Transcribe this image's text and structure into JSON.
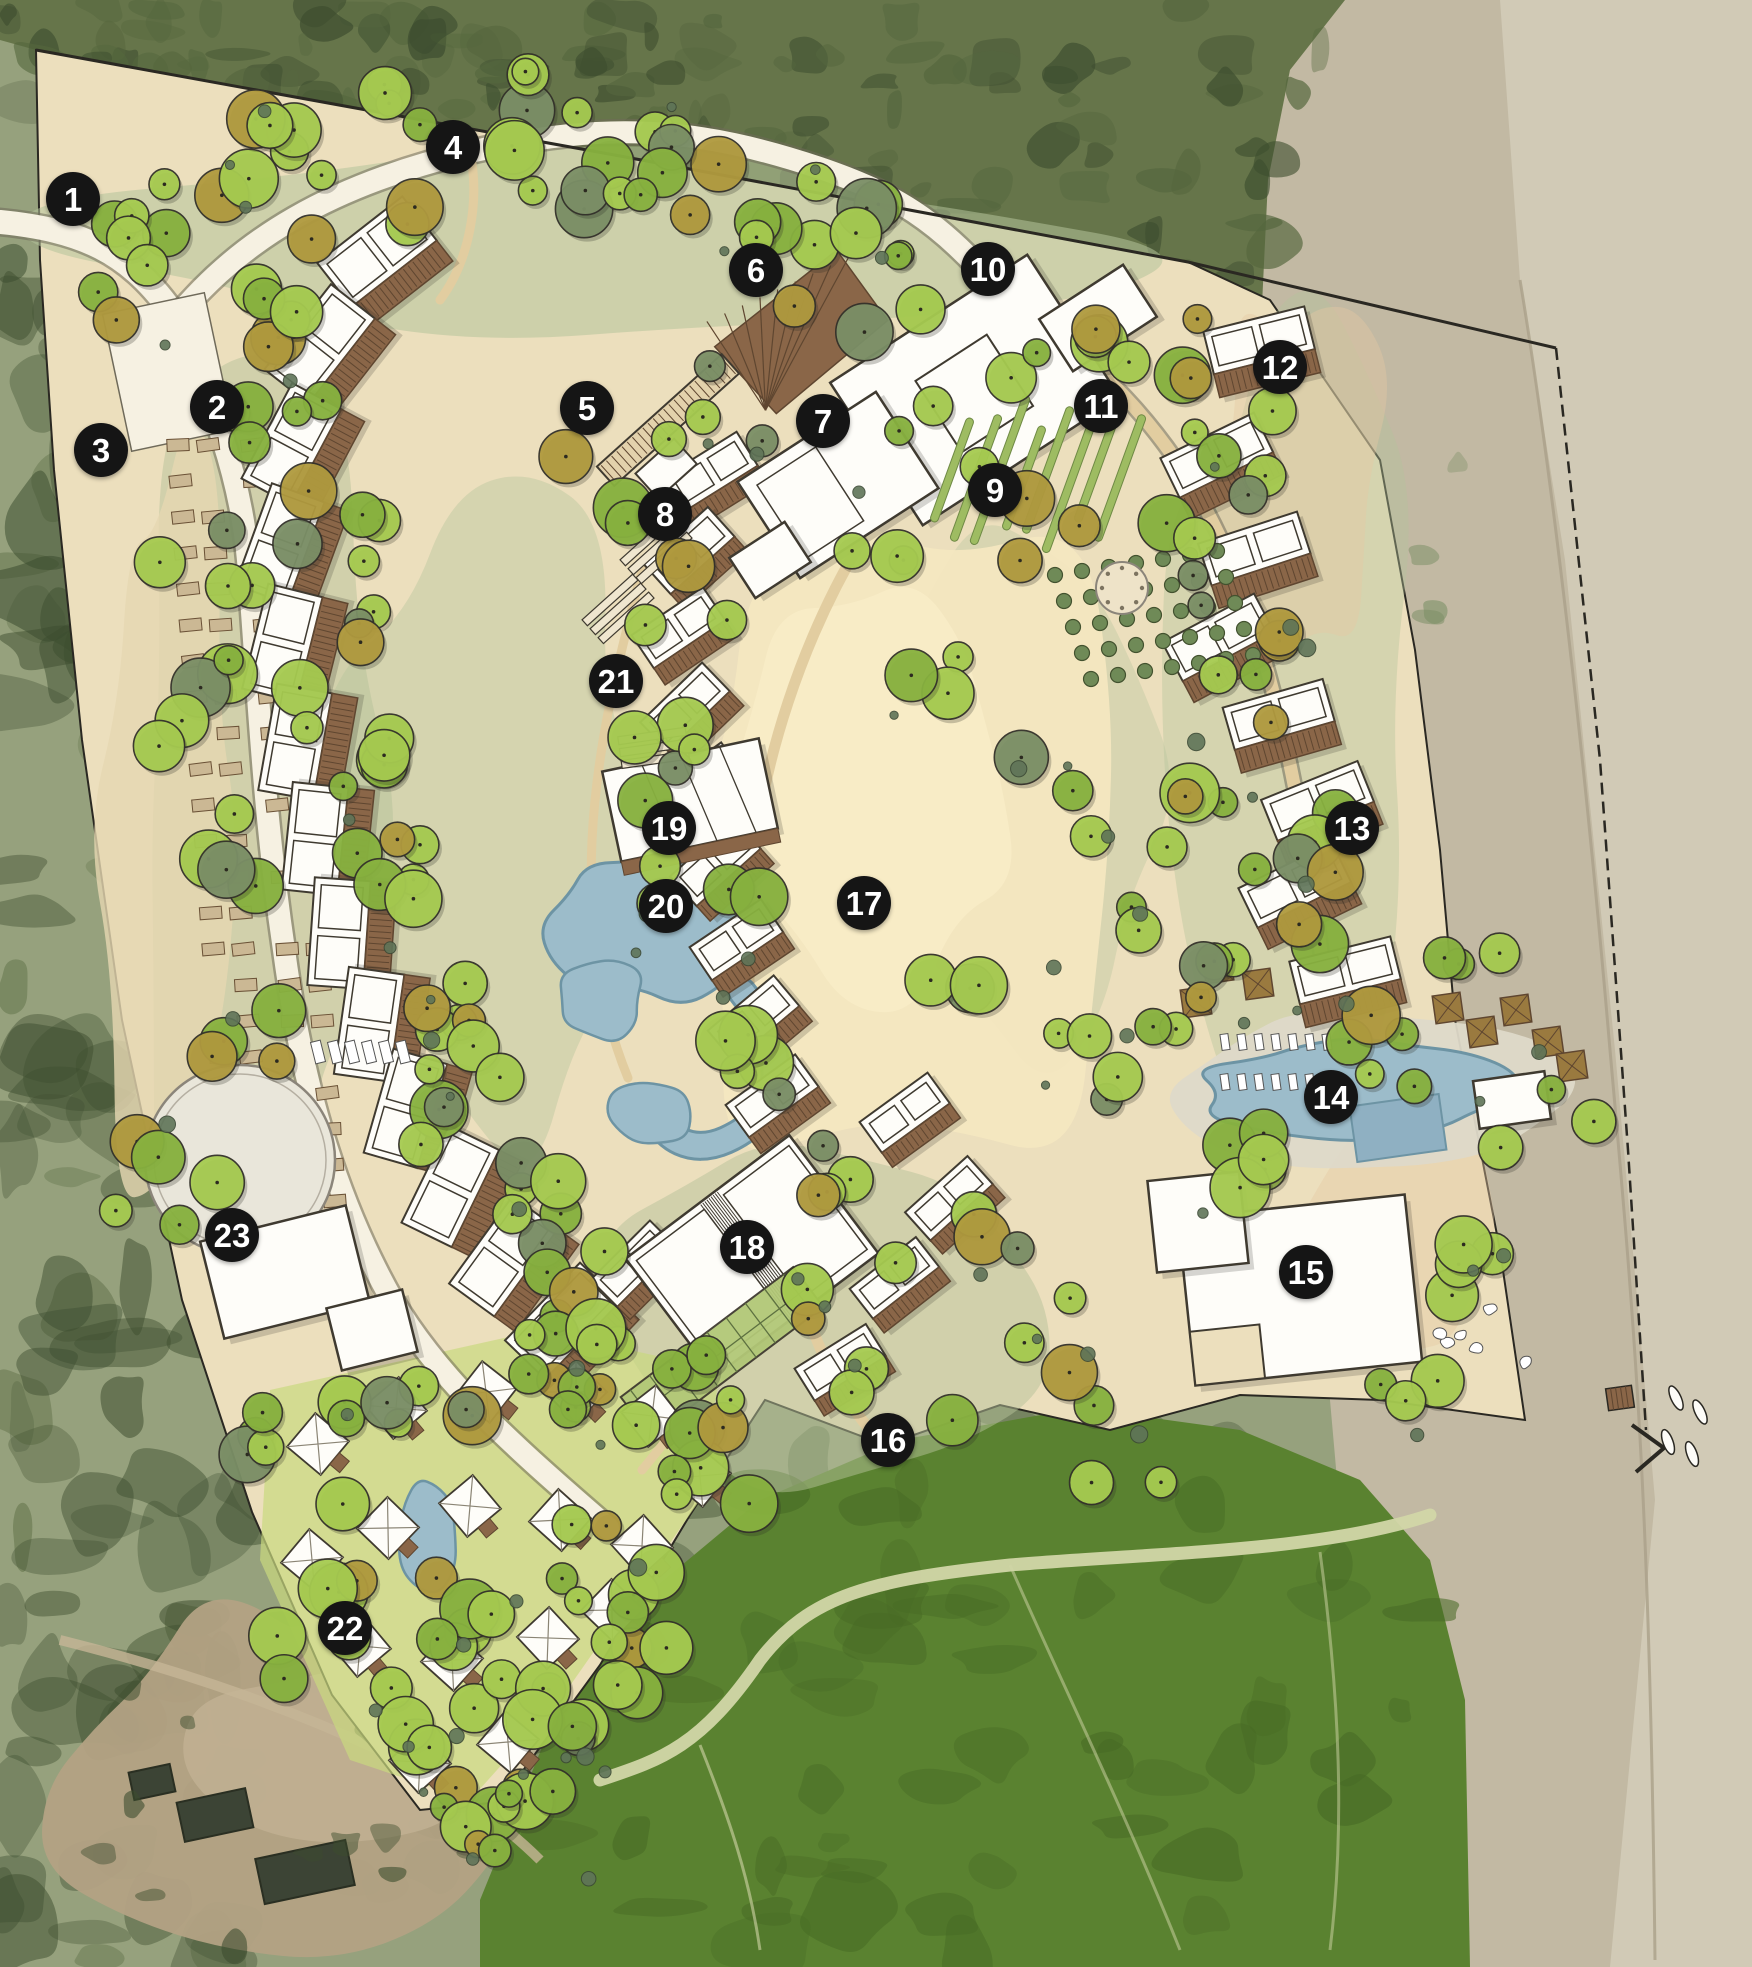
{
  "canvas": {
    "width": 1752,
    "height": 1967
  },
  "markers": {
    "style": {
      "diameter_px": 54,
      "background": "#151515",
      "text_color": "#ffffff",
      "font_size_px": 33
    },
    "items": [
      {
        "label": "1",
        "x": 73,
        "y": 199
      },
      {
        "label": "2",
        "x": 217,
        "y": 407
      },
      {
        "label": "3",
        "x": 101,
        "y": 450
      },
      {
        "label": "4",
        "x": 453,
        "y": 147
      },
      {
        "label": "5",
        "x": 587,
        "y": 408
      },
      {
        "label": "6",
        "x": 756,
        "y": 270
      },
      {
        "label": "7",
        "x": 823,
        "y": 421
      },
      {
        "label": "8",
        "x": 665,
        "y": 514
      },
      {
        "label": "9",
        "x": 995,
        "y": 490
      },
      {
        "label": "10",
        "x": 988,
        "y": 269
      },
      {
        "label": "11",
        "x": 1101,
        "y": 406
      },
      {
        "label": "12",
        "x": 1280,
        "y": 367
      },
      {
        "label": "13",
        "x": 1352,
        "y": 828
      },
      {
        "label": "14",
        "x": 1331,
        "y": 1097
      },
      {
        "label": "15",
        "x": 1306,
        "y": 1272
      },
      {
        "label": "16",
        "x": 888,
        "y": 1440
      },
      {
        "label": "17",
        "x": 864,
        "y": 903
      },
      {
        "label": "18",
        "x": 747,
        "y": 1247
      },
      {
        "label": "19",
        "x": 669,
        "y": 828
      },
      {
        "label": "20",
        "x": 666,
        "y": 906
      },
      {
        "label": "21",
        "x": 616,
        "y": 681
      },
      {
        "label": "22",
        "x": 345,
        "y": 1628
      },
      {
        "label": "23",
        "x": 232,
        "y": 1235
      }
    ]
  },
  "palette": {
    "aerial_base": "#96a17d",
    "aerial_dark": "#55673e",
    "aerial_darker": "#3d4d2f",
    "beach_inner": "#c2b9a3",
    "beach_outer": "#d1cab6",
    "tide_line": "#aaa089",
    "lawn": "#5a8230",
    "lawn_dark": "#476a25",
    "lawn_path": "#d2d6a8",
    "dirt": "#b3a284",
    "site_sand": "#ecdfbd",
    "dune": "#f4e7c0",
    "sage_wash": "#b5c29a",
    "lime_wash": "#c9d87f",
    "peach_wash": "#e7c9a2",
    "road_fill": "#f6f1e2",
    "road_casing": "#6f6a5a",
    "path_sand": "#e2cda0",
    "building_white": "#fefdf9",
    "building_outline": "#3f3a30",
    "deck_brown": "#8a6648",
    "deck_line": "#5f4630",
    "pool": "#9cbcca",
    "pool_dark": "#6d94a4",
    "trellis": "#b2c877",
    "tree_bright": "#a6cb50",
    "tree_mid": "#88b23f",
    "tree_olive": "#b09a3e",
    "tree_sage": "#7b8f66",
    "shrub": "#5f7458",
    "ink": "#2a2822"
  }
}
